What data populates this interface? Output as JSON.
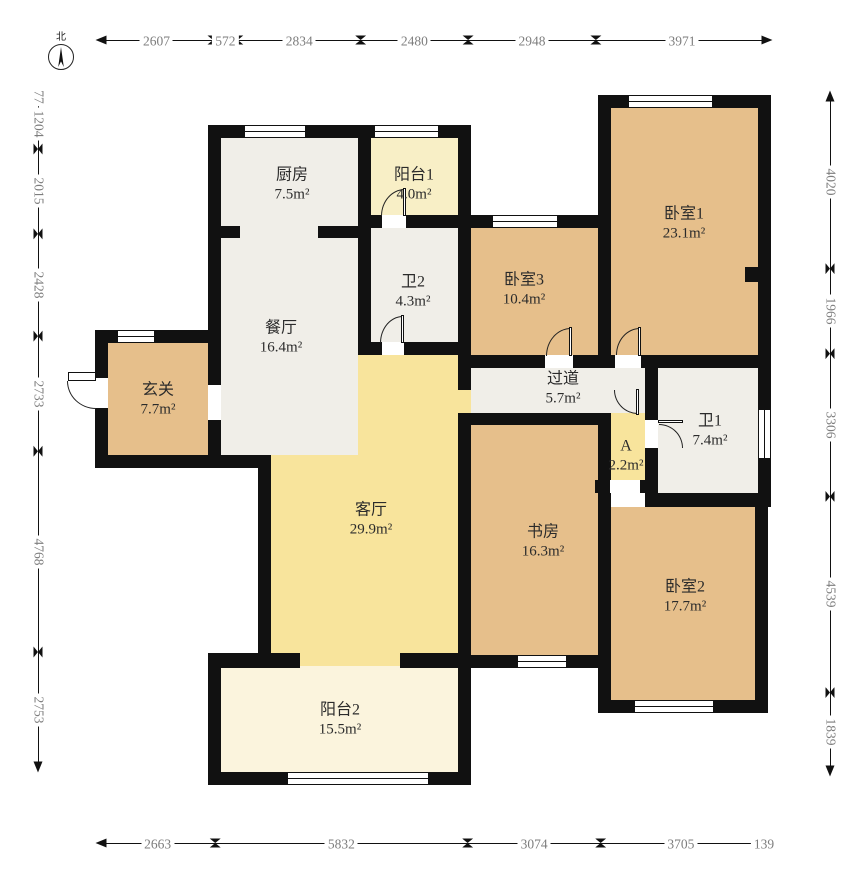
{
  "compass": {
    "label": "北"
  },
  "palette": {
    "wall": "#111111",
    "wood": "#e6bf8b",
    "marble": "#f0eee8",
    "living": "#f8e49c",
    "balcony1": "#f8efc6",
    "balcony2": "#fbf4dd",
    "dim_text": "#7d7d7d",
    "label_text": "#2b2b2b"
  },
  "dimensions": {
    "top": {
      "dir": "h",
      "x": 100,
      "y": 40,
      "len": 668,
      "segments": [
        "2607",
        "572",
        "2834",
        "2480",
        "2948",
        "3971"
      ]
    },
    "bottom": {
      "dir": "h",
      "x": 100,
      "y": 843,
      "len": 667,
      "segments": [
        "2663",
        "5832",
        "3074",
        "3705",
        "139"
      ]
    },
    "left": {
      "dir": "v",
      "x": 38,
      "y": 95,
      "len": 673,
      "segments": [
        "77",
        "1204",
        "2015",
        "2428",
        "2733",
        "4768",
        "2753"
      ]
    },
    "right": {
      "dir": "v",
      "x": 830,
      "y": 95,
      "len": 677,
      "segments": [
        "4020",
        "1966",
        "3306",
        "4539",
        "1839"
      ]
    }
  },
  "rooms": [
    {
      "id": "kitchen",
      "name": "厨房",
      "area": "7.5m²",
      "fill": "marble",
      "rects": [
        [
          221,
          138,
          137,
          317
        ]
      ],
      "label_at": [
        292,
        185
      ]
    },
    {
      "id": "balcony1",
      "name": "阳台1",
      "area": "4.0m²",
      "fill": "balcony1",
      "rects": [
        [
          371,
          138,
          87,
          77
        ]
      ],
      "label_at": [
        414,
        185
      ]
    },
    {
      "id": "bath2",
      "name": "卫2",
      "area": "4.3m²",
      "fill": "marble",
      "rects": [
        [
          371,
          228,
          87,
          114
        ]
      ],
      "label_at": [
        413,
        292
      ]
    },
    {
      "id": "dining",
      "name": "餐厅",
      "area": "16.4m²",
      "fill": "marble",
      "rects": [],
      "label_at": [
        281,
        338
      ]
    },
    {
      "id": "hallway",
      "name": "玄关",
      "area": "7.7m²",
      "fill": "wood",
      "rects": [
        [
          108,
          343,
          100,
          112
        ]
      ],
      "label_at": [
        158,
        400
      ]
    },
    {
      "id": "bedroom3",
      "name": "卧室3",
      "area": "10.4m²",
      "fill": "wood",
      "rects": [
        [
          471,
          228,
          127,
          127
        ]
      ],
      "label_at": [
        524,
        290
      ]
    },
    {
      "id": "bedroom1",
      "name": "卧室1",
      "area": "23.1m²",
      "fill": "wood",
      "rects": [
        [
          611,
          108,
          147,
          247
        ]
      ],
      "label_at": [
        684,
        224
      ]
    },
    {
      "id": "corridor",
      "name": "过道",
      "area": "5.7m²",
      "fill": "marble",
      "rects": [
        [
          471,
          368,
          174,
          45
        ]
      ],
      "label_at": [
        563,
        389
      ]
    },
    {
      "id": "bath1",
      "name": "卫1",
      "area": "7.4m²",
      "fill": "marble",
      "rects": [
        [
          658,
          368,
          100,
          125
        ]
      ],
      "label_at": [
        710,
        431
      ]
    },
    {
      "id": "room-a",
      "name": "A",
      "area": "2.2m²",
      "fill": "living",
      "rects": [
        [
          608,
          413,
          37,
          67
        ],
        [
          458,
          390,
          13,
          23
        ]
      ],
      "label_at": [
        626,
        456
      ]
    },
    {
      "id": "living",
      "name": "客厅",
      "area": "29.9m²",
      "fill": "living",
      "rects": [
        [
          271,
          455,
          187,
          198
        ],
        [
          358,
          355,
          100,
          100
        ],
        [
          300,
          653,
          100,
          15
        ]
      ],
      "label_at": [
        371,
        520
      ]
    },
    {
      "id": "study",
      "name": "书房",
      "area": "16.3m²",
      "fill": "wood",
      "rects": [
        [
          471,
          425,
          127,
          230
        ]
      ],
      "label_at": [
        543,
        542
      ]
    },
    {
      "id": "bedroom2",
      "name": "卧室2",
      "area": "17.7m²",
      "fill": "wood",
      "rects": [
        [
          611,
          507,
          144,
          193
        ]
      ],
      "label_at": [
        685,
        597
      ]
    },
    {
      "id": "balcony2",
      "name": "阳台2",
      "area": "15.5m²",
      "fill": "balcony2",
      "rects": [
        [
          221,
          666,
          237,
          106
        ]
      ],
      "label_at": [
        340,
        720
      ]
    }
  ],
  "walls": [
    [
      598,
      95,
      173,
      13
    ],
    [
      758,
      95,
      13,
      412
    ],
    [
      208,
      125,
      263,
      13
    ],
    [
      208,
      125,
      13,
      343
    ],
    [
      358,
      138,
      13,
      217
    ],
    [
      458,
      125,
      13,
      230
    ],
    [
      221,
      226,
      19,
      12
    ],
    [
      318,
      226,
      40,
      12
    ],
    [
      358,
      215,
      113,
      13
    ],
    [
      458,
      215,
      153,
      13
    ],
    [
      598,
      95,
      13,
      273
    ],
    [
      358,
      342,
      113,
      13
    ],
    [
      458,
      355,
      313,
      13
    ],
    [
      458,
      368,
      13,
      22
    ],
    [
      458,
      413,
      150,
      12
    ],
    [
      645,
      368,
      13,
      125
    ],
    [
      595,
      480,
      50,
      13
    ],
    [
      645,
      493,
      126,
      14
    ],
    [
      598,
      413,
      13,
      300
    ],
    [
      755,
      493,
      13,
      220
    ],
    [
      598,
      700,
      170,
      13
    ],
    [
      458,
      655,
      140,
      13
    ],
    [
      458,
      425,
      13,
      243
    ],
    [
      95,
      330,
      126,
      13
    ],
    [
      95,
      330,
      13,
      138
    ],
    [
      95,
      455,
      126,
      13
    ],
    [
      208,
      330,
      13,
      138
    ],
    [
      208,
      455,
      63,
      13
    ],
    [
      258,
      455,
      13,
      211
    ],
    [
      208,
      653,
      92,
      15
    ],
    [
      400,
      653,
      71,
      15
    ],
    [
      208,
      653,
      13,
      132
    ],
    [
      458,
      653,
      13,
      132
    ],
    [
      208,
      772,
      263,
      13
    ],
    [
      745,
      267,
      13,
      15
    ]
  ],
  "openings": [
    [
      95,
      378,
      13,
      30
    ],
    [
      208,
      385,
      13,
      35
    ],
    [
      382,
      215,
      24,
      13
    ],
    [
      382,
      342,
      22,
      13
    ],
    [
      545,
      355,
      28,
      13
    ],
    [
      615,
      355,
      26,
      13
    ],
    [
      645,
      420,
      13,
      28
    ],
    [
      610,
      480,
      30,
      13
    ],
    [
      611,
      493,
      29,
      14
    ]
  ],
  "windows": [
    {
      "rect": [
        245,
        125,
        60,
        13
      ],
      "v": false
    },
    {
      "rect": [
        375,
        125,
        63,
        13
      ],
      "v": false
    },
    {
      "rect": [
        629,
        95,
        83,
        13
      ],
      "v": false
    },
    {
      "rect": [
        493,
        215,
        64,
        13
      ],
      "v": false
    },
    {
      "rect": [
        118,
        330,
        36,
        13
      ],
      "v": false
    },
    {
      "rect": [
        758,
        410,
        13,
        48
      ],
      "v": true
    },
    {
      "rect": [
        518,
        655,
        48,
        13
      ],
      "v": false
    },
    {
      "rect": [
        635,
        700,
        78,
        13
      ],
      "v": false
    },
    {
      "rect": [
        288,
        772,
        140,
        13
      ],
      "v": false
    }
  ],
  "doors": [
    {
      "id": "entrance-door",
      "arc": [
        67,
        381,
        29,
        28
      ],
      "corner": "bl",
      "leaf": [
        68,
        372,
        28,
        9
      ]
    },
    {
      "id": "balcony1-door",
      "arc": [
        381,
        189,
        24,
        27
      ],
      "corner": "tl",
      "leaf": [
        403,
        188,
        3,
        28
      ]
    },
    {
      "id": "bath2-door",
      "arc": [
        380,
        316,
        23,
        27
      ],
      "corner": "tl",
      "leaf": [
        401,
        315,
        3,
        28
      ]
    },
    {
      "id": "bedroom3-door",
      "arc": [
        546,
        328,
        25,
        28
      ],
      "corner": "tl",
      "leaf": [
        569,
        327,
        3,
        29
      ]
    },
    {
      "id": "bedroom1-door",
      "arc": [
        616,
        328,
        24,
        27
      ],
      "corner": "tl",
      "leaf": [
        638,
        327,
        3,
        29
      ]
    },
    {
      "id": "corridor-a-door",
      "arc": [
        614,
        390,
        24,
        24
      ],
      "corner": "bl",
      "leaf": [
        636,
        389,
        3,
        26
      ]
    },
    {
      "id": "bath1-door",
      "arc": [
        659,
        424,
        24,
        24
      ],
      "corner": "tr",
      "leaf": [
        658,
        420,
        25,
        3
      ]
    }
  ]
}
